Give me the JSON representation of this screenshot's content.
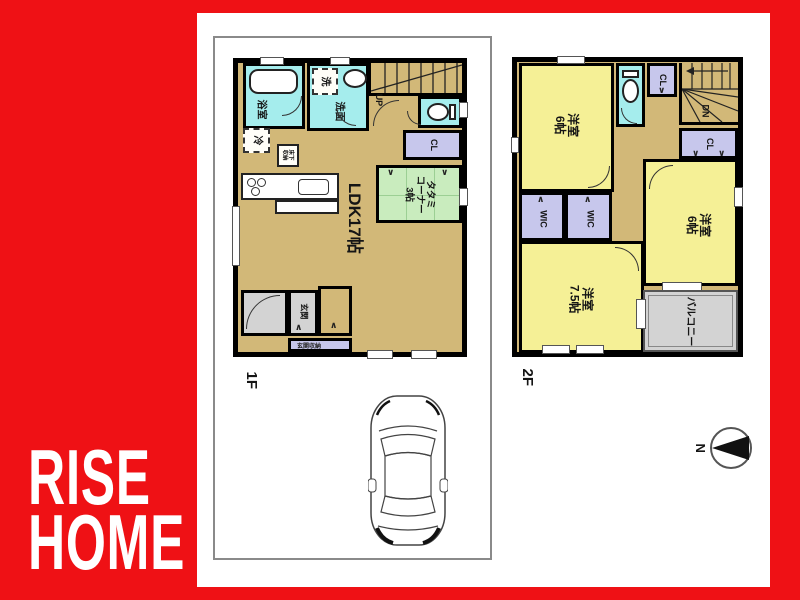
{
  "brand": {
    "line1": "RISE",
    "line2": "HOME"
  },
  "floor1": {
    "label": "1F",
    "ldk": "LDK17帖",
    "tatami": {
      "l1": "タタミ",
      "l2": "コーナー",
      "l3": "3帖"
    },
    "bath": "浴室",
    "washroom": "洗面",
    "laundry": "洗",
    "fridge": "冷",
    "underfloor": {
      "l1": "床下",
      "l2": "収納"
    },
    "closet": "CL",
    "up": "UP",
    "entrance": "玄関",
    "entrance_storage": "玄関収納"
  },
  "floor2": {
    "label": "2F",
    "room_nw": {
      "l1": "洋室",
      "l2": "6帖"
    },
    "room_e": {
      "l1": "洋室",
      "l2": "6帖"
    },
    "room_sw": {
      "l1": "洋室",
      "l2": "7.5帖"
    },
    "wic_w": "WIC",
    "wic_e": "WIC",
    "closet_n": "CL",
    "closet_e": "CL",
    "down": "DN",
    "balcony": "バルコニー"
  },
  "compass": {
    "north": "N"
  },
  "colors": {
    "background_red": "#EF1115",
    "floor_tan": "#D2B878",
    "wet_area_cyan": "#A5EDED",
    "bedroom_yellow": "#F5F096",
    "tatami_green": "#C9ECBE",
    "closet_purple": "#C7C7EC",
    "porch_gray": "#D3D3D3"
  }
}
